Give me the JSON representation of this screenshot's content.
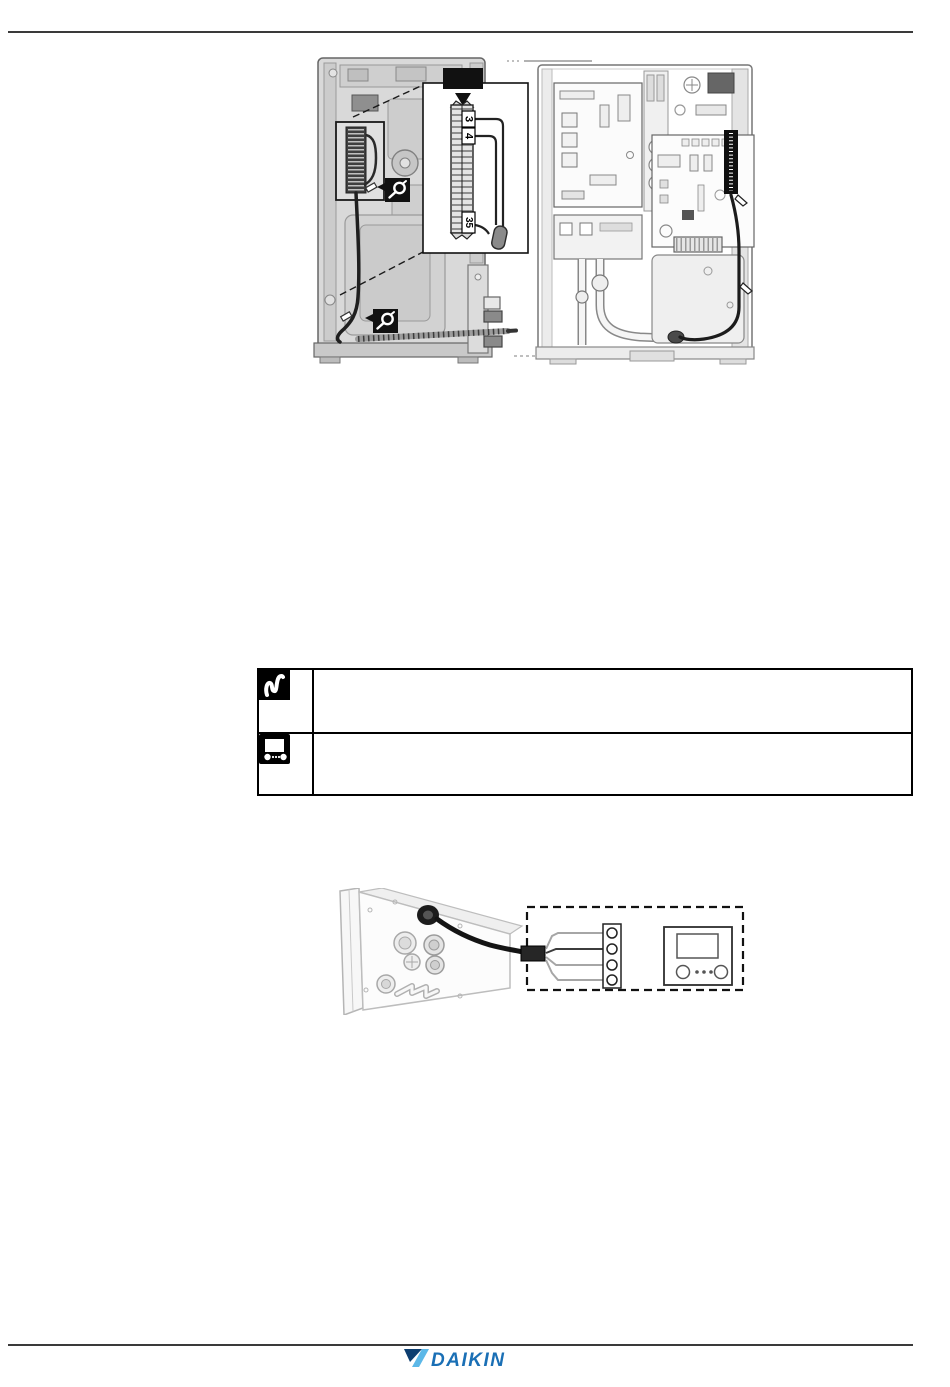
{
  "page": {
    "background": "#ffffff",
    "rule_color": "#3a3a3a"
  },
  "top_figure": {
    "terminal_labels": [
      "3",
      "4",
      "35"
    ],
    "callout_tag_color": "#111111",
    "icons": [
      "cable-tie-icon",
      "cable-tie-icon"
    ]
  },
  "info_table": {
    "rows": [
      {
        "icon": "field-wiring-icon",
        "text": ""
      },
      {
        "icon": "user-interface-icon",
        "text": ""
      }
    ]
  },
  "bottom_figure": {
    "terminal_count": 4,
    "icons": [
      "room-thermostat"
    ]
  },
  "footer": {
    "logo_text": "DAIKIN",
    "logo_colors": {
      "text": "#1a6fb5",
      "mark_light": "#5cb8e8",
      "mark_dark": "#0d3e70"
    }
  }
}
